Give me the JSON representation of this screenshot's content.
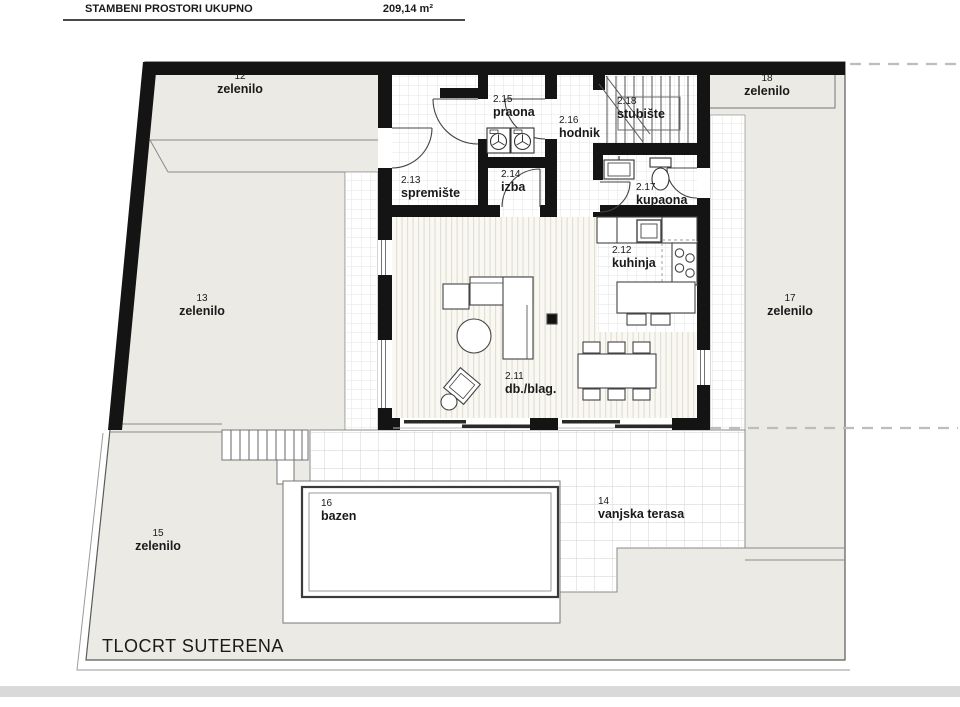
{
  "header": {
    "title": "STAMBENI PROSTORI UKUPNO",
    "total_area": "209,14 m²"
  },
  "plan_title": "TLOCRT SUTERENA",
  "rooms": {
    "dnevni_blag": {
      "number": "2.11",
      "name": "db./blag."
    },
    "kuhinja": {
      "number": "2.12",
      "name": "kuhinja"
    },
    "spremiste": {
      "number": "2.13",
      "name": "spremište"
    },
    "izba": {
      "number": "2.14",
      "name": "izba"
    },
    "praona": {
      "number": "2.15",
      "name": "praona"
    },
    "hodnik": {
      "number": "2.16",
      "name": "hodnik"
    },
    "kupaona": {
      "number": "2.17",
      "name": "kupaona"
    },
    "stubiste": {
      "number": "2.18",
      "name": "stubište"
    }
  },
  "outdoor_areas": {
    "zelenilo_12": {
      "number": "12",
      "name": "zelenilo"
    },
    "zelenilo_13": {
      "number": "13",
      "name": "zelenilo"
    },
    "vanjska_terasa": {
      "number": "14",
      "name": "vanjska terasa"
    },
    "zelenilo_15": {
      "number": "15",
      "name": "zelenilo"
    },
    "bazen": {
      "number": "16",
      "name": "bazen"
    },
    "zelenilo_17": {
      "number": "17",
      "name": "zelenilo"
    },
    "zelenilo_18": {
      "number": "18",
      "name": "zelenilo"
    }
  },
  "colors": {
    "wall": "#141414",
    "site_fill": "#ebeae5",
    "floor_stripe_base": "#f9f8f2",
    "grid_line": "#d9d9d9",
    "boundary_dash": "#bdbdbd"
  }
}
